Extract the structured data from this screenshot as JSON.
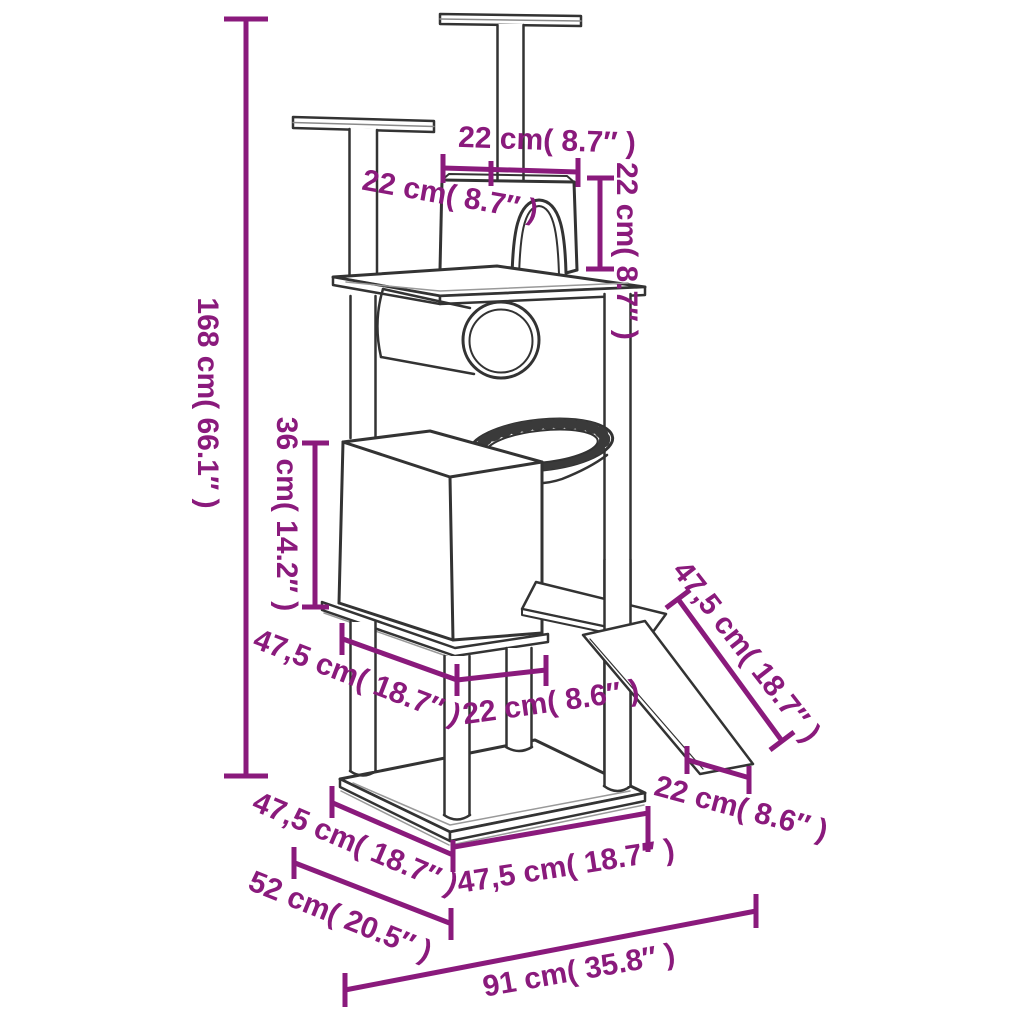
{
  "diagram": {
    "title": "Cat tree dimension diagram",
    "subject": "cat tree with scratching posts, house, tunnel, basket and ramp",
    "accent_color": "#8a1a7c",
    "line_color": "#333333",
    "background_color": "#ffffff",
    "dimensions": [
      {
        "id": "total-height",
        "cm": "168",
        "inch": "66.1",
        "label": "168 cm( 66.1″ )"
      },
      {
        "id": "top-house-width",
        "cm": "22",
        "inch": "8.7",
        "label": "22 cm( 8.7″ )"
      },
      {
        "id": "house-depth",
        "cm": "22",
        "inch": "8.7",
        "label": "22 cm( 8.7″ )"
      },
      {
        "id": "house-height",
        "cm": "22",
        "inch": "8.7",
        "label": "22 cm( 8.7″ )"
      },
      {
        "id": "condo-height",
        "cm": "36",
        "inch": "14.2",
        "label": "36 cm( 14.2″ )"
      },
      {
        "id": "middle-platform-width",
        "cm": "47,5",
        "inch": "18.7",
        "label": "47,5 cm( 18.7″ )"
      },
      {
        "id": "middle-step-width",
        "cm": "22",
        "inch": "8.6",
        "label": "22 cm( 8.6″ )"
      },
      {
        "id": "ramp-length",
        "cm": "47,5",
        "inch": "18.7",
        "label": "47,5 cm( 18.7″ )"
      },
      {
        "id": "ramp-bottom-width",
        "cm": "22",
        "inch": "8.6",
        "label": "22 cm( 8.6″ )"
      },
      {
        "id": "base-depth",
        "cm": "47,5",
        "inch": "18.7",
        "label": "47,5 cm( 18.7″ )"
      },
      {
        "id": "base-width",
        "cm": "47,5",
        "inch": "18.7",
        "label": "47,5 cm( 18.7″ )"
      },
      {
        "id": "footprint-depth",
        "cm": "52",
        "inch": "20.5",
        "label": "52 cm( 20.5″ )"
      },
      {
        "id": "footprint-width",
        "cm": "91",
        "inch": "35.8",
        "label": "91 cm( 35.8″ )"
      }
    ]
  }
}
